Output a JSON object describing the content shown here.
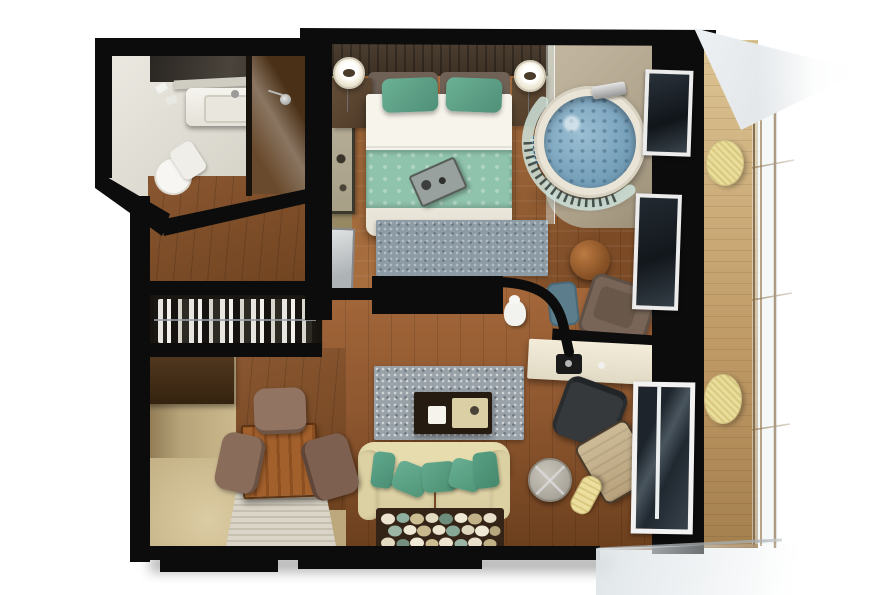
{
  "scene": {
    "type": "3d-floor-plan-render",
    "description": "Top-down 3D architectural rendering of a one-bedroom suite with bathroom, wardrobe hallway, bedroom with whirlpool corner, work corner, living room, dining nook and a private balcony",
    "background": "#ffffff"
  },
  "palette": {
    "wall": "#0c0c0c",
    "wood_floor": "#9a6234",
    "teal_accent": "#5fa289",
    "bed_runner_teal": "#8fc3ac",
    "sofa_cream": "#e0d5a6",
    "water_blue": "#7fa6bf",
    "pouf_yellow": "#e9dd9b",
    "rug_blue_gray": "#8d9ba5",
    "speckled_rug_gray": "#99a2a9",
    "beige_wall": "#b7a379",
    "deck_tan": "#c9a97c",
    "dining_table_wood": "#9c5a28"
  },
  "rooms": {
    "bathroom": {
      "label": "Bathroom",
      "items": [
        "vanity-sink",
        "mirror",
        "shelf",
        "toilet",
        "shower",
        "towels"
      ]
    },
    "wardrobe_hallway": {
      "label": "Wardrobe hallway",
      "items": [
        "wardrobe-clothes-rail",
        "entry-floor"
      ]
    },
    "bedroom": {
      "label": "Bedroom",
      "items": [
        "king-bed",
        "teal-pillow-left",
        "teal-pillow-right",
        "bed-runner",
        "breakfast-tray",
        "headboard",
        "headboard-cushions",
        "nightstand-left",
        "nightstand-right",
        "pendant-lamp-left",
        "pendant-lamp-right",
        "wall-art",
        "wall-mirror-panel",
        "bedside-basket",
        "foot-rug",
        "tv-partition"
      ]
    },
    "spa_corner": {
      "label": "Whirlpool corner",
      "items": [
        "round-whirlpool-tub",
        "curved-glass-screen",
        "chrome-faucet",
        "spa-deck",
        "glass-partition"
      ]
    },
    "work_corner": {
      "label": "Work corner",
      "items": [
        "writing-desk",
        "espresso-machine",
        "desk-chair",
        "armchair",
        "round-wood-table",
        "teal-ottoman",
        "white-figurine"
      ]
    },
    "living_room": {
      "label": "Living room",
      "items": [
        "sofa",
        "sofa-pillows",
        "coffee-table",
        "tray",
        "speckled-rug",
        "pebble-rug",
        "round-side-table",
        "lounge-chair",
        "yellow-bolster"
      ]
    },
    "dining_nook": {
      "label": "Dining nook",
      "items": [
        "dining-table",
        "dining-chair-top",
        "dining-chair-left",
        "dining-chair-right",
        "striped-rug",
        "sideboard"
      ]
    },
    "balcony": {
      "label": "Balcony",
      "items": [
        "deck",
        "glass-railing",
        "overhang",
        "yellow-pouf-upper",
        "yellow-pouf-lower"
      ]
    }
  }
}
